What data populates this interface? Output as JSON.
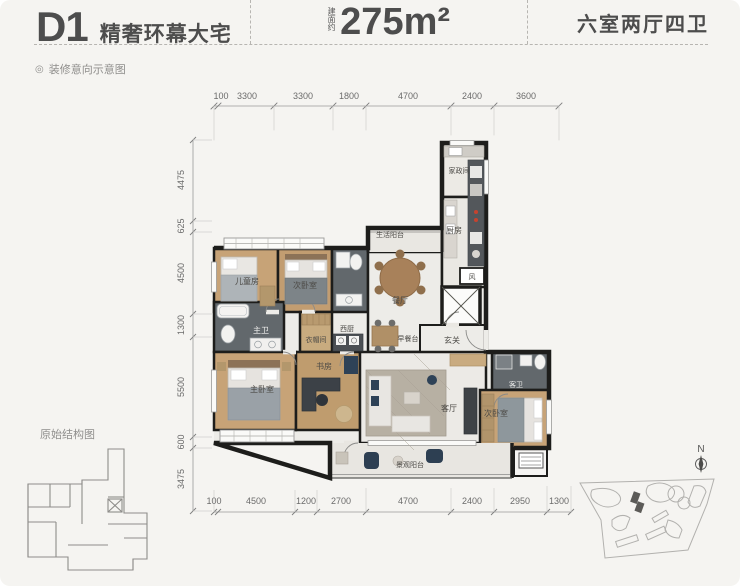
{
  "header": {
    "unit": "D1",
    "tagline": "精奢环幕大宅",
    "area_prefix": "建面约",
    "area_value": "275m²",
    "layout": "六室两厅四卫"
  },
  "note": {
    "icon": "◎",
    "text": "装修意向示意图"
  },
  "plan": {
    "dims_top": [
      "100",
      "3300",
      "3300",
      "1800",
      "4700",
      "2400",
      "3600"
    ],
    "dims_bottom": [
      "100",
      "4500",
      "1200",
      "2700",
      "4700",
      "2400",
      "2950",
      "1300"
    ],
    "dims_left": [
      "4475",
      "625",
      "4500",
      "1300",
      "5500",
      "600",
      "3475"
    ],
    "rooms": {
      "kids": "儿童房",
      "bedroom2": "次卧室",
      "service_balcony": "生活阳台",
      "housekeeping": "家政间",
      "kitchen": "厨房",
      "dining": "餐厅",
      "vent": "风",
      "foyer": "玄关",
      "breakfast_bar": "早餐台",
      "west_kitchen": "西厨",
      "master_bath": "主卫",
      "closet": "衣帽间",
      "master_bedroom": "主卧室",
      "study": "书房",
      "living": "客厅",
      "guest_bath": "客卫",
      "bedroom3": "次卧室",
      "view_balcony": "景观阳台"
    }
  },
  "footer": {
    "structure_label": "原始结构图",
    "north_label": "N"
  },
  "colors": {
    "wall": "#1d1d1b",
    "wood": "#c7a377",
    "tile": "#edece8",
    "bath": "#62686c",
    "accent_dark": "#2e4257"
  }
}
